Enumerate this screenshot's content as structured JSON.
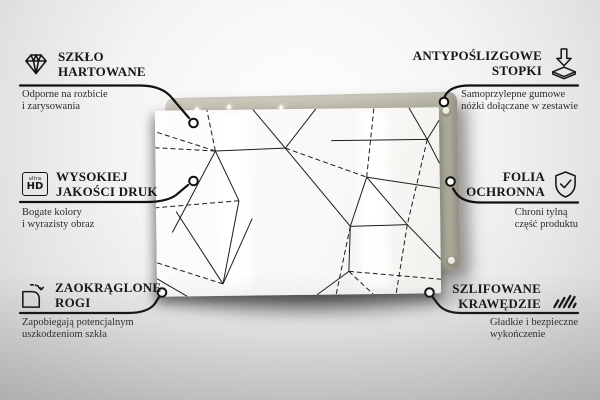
{
  "image_type": "product-feature-infographic",
  "colors": {
    "background": "#ececec",
    "board": "#c6c3b4",
    "glass": "#fbfbfa",
    "line": "#141414",
    "text": "#161616"
  },
  "product": {
    "pattern_name": "geometric-triangle-lines"
  },
  "features": [
    {
      "position": "top-left",
      "icon": "diamond-icon",
      "title_line1": "SZKŁO",
      "title_line2": "HARTOWANE",
      "desc_line1": "Odporne na rozbicie",
      "desc_line2": "i zarysowania"
    },
    {
      "position": "top-right",
      "icon": "anti-slip-feet-icon",
      "title_line1": "ANTYPOŚLIZGOWE",
      "title_line2": "STOPKI",
      "desc_line1": "Samoprzylepne gumowe",
      "desc_line2": "nóżki dołączane w zestawie"
    },
    {
      "position": "middle-left",
      "icon": "ultra-hd-icon",
      "icon_text_top": "ultra",
      "icon_text_bottom": "HD",
      "title_line1": "WYSOKIEJ",
      "title_line2": "JAKOŚCI DRUK",
      "desc_line1": "Bogate kolory",
      "desc_line2": "i wyrazisty obraz"
    },
    {
      "position": "middle-right",
      "icon": "shield-check-icon",
      "title_line1": "FOLIA",
      "title_line2": "OCHRONNA",
      "desc_line1": "Chroni tylną",
      "desc_line2": "część produktu"
    },
    {
      "position": "bottom-left",
      "icon": "rounded-corner-icon",
      "title_line1": "ZAOKRĄGLONE",
      "title_line2": "ROGI",
      "desc_line1": "Zapobiegają potencjalnym",
      "desc_line2": "uszkodzeniom szkła"
    },
    {
      "position": "bottom-right",
      "icon": "polished-edges-icon",
      "title_line1": "SZLIFOWANE",
      "title_line2": "KRAWĘDZIE",
      "desc_line1": "Gładkie i bezpieczne",
      "desc_line2": "wykończenie"
    }
  ]
}
